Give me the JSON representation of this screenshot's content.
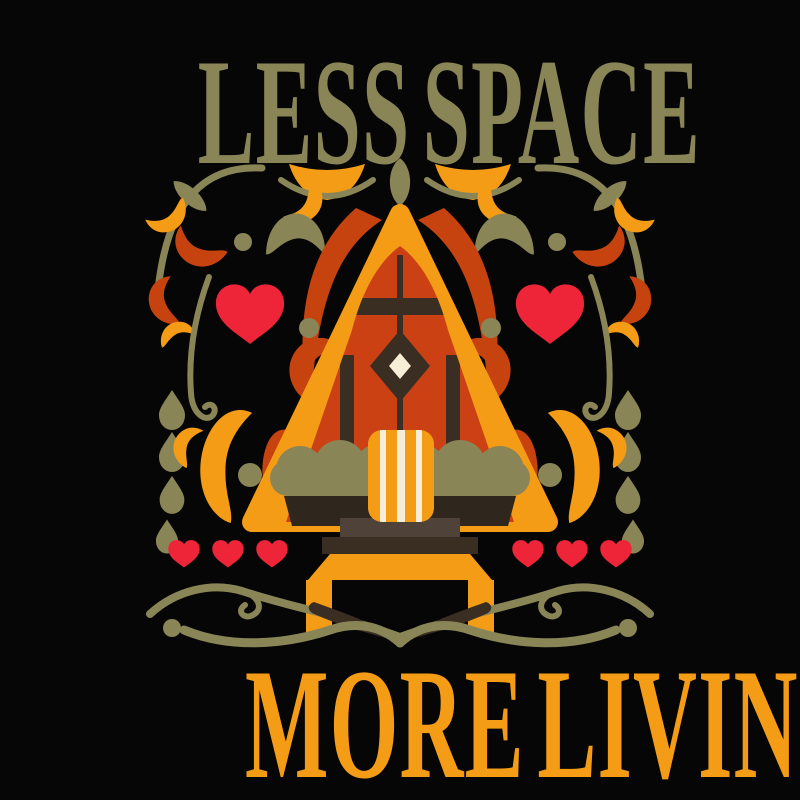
{
  "poster": {
    "title_top": "LESS SPACE",
    "title_bottom": "MORE LIVING"
  },
  "palette": {
    "background": "#060606",
    "olive": "#8a8556",
    "orange": "#f59c17",
    "rust": "#c6420f",
    "cabin-red": "#cb4113",
    "heart-red": "#ee2438",
    "dark-brown": "#3a2d22",
    "deep-brown": "#2f261d",
    "step-gray": "#4f4339",
    "cream": "#f6eed6"
  },
  "illustration": {
    "subject": "a-frame-cabin",
    "motifs": [
      "a-frame-cabin",
      "diamond-window",
      "striped-armchair",
      "shrubs",
      "pedestal-steps",
      "bench",
      "heart",
      "leaf",
      "paisley-swirl",
      "teardrop",
      "vine",
      "wave",
      "dot"
    ]
  }
}
